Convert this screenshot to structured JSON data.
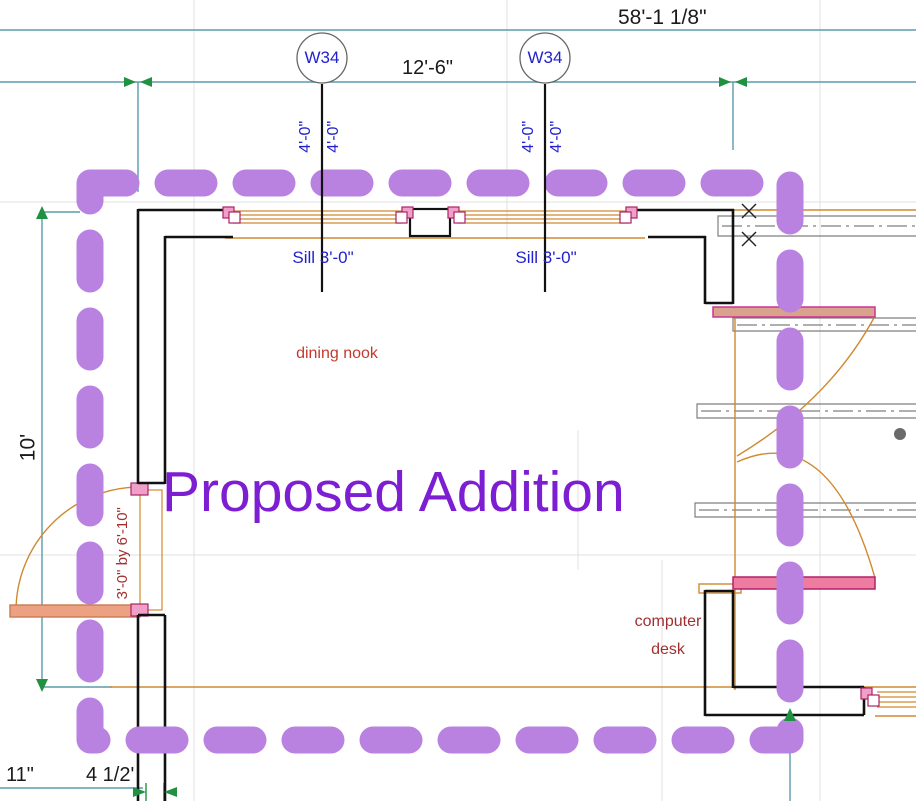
{
  "canvas": {
    "width": 916,
    "height": 801
  },
  "colors": {
    "proposed_boundary_purple": "#b982e1",
    "proposed_text_purple": "#7d1ed2",
    "annotation_blue": "#2222cc",
    "room_label_red": "#c4392d",
    "door_label_maroon": "#a03030",
    "dimension_teal": "#5b9bac",
    "marker_green": "#1f9140",
    "wall_black": "#111111",
    "existing_wall_gray": "#7f7f7f",
    "fixture_orange": "#d08930",
    "door_panel_fill": "#eda183",
    "jamb_pink": "#f0a0c8",
    "header_bar_pink": "#ee7ba0",
    "grid_gray": "#e0e0e0"
  },
  "labels": {
    "proposed_addition": "Proposed Addition",
    "dining_nook": "dining nook",
    "computer_desk_line1": "computer",
    "computer_desk_line2": "desk",
    "door_size": "3'-0\" by 6'-10\"",
    "door_tag_partial": "D",
    "window_tag": "W34",
    "window_sill": "Sill 3'-0\""
  },
  "dimensions": {
    "overall_width": "58'-1 1/8\"",
    "window_spacing": "12'-6\"",
    "window_offset": "4'-0\"",
    "left_height": "10'",
    "bottom_offset": "11\"",
    "bottom_wall": "4 1/2'"
  }
}
